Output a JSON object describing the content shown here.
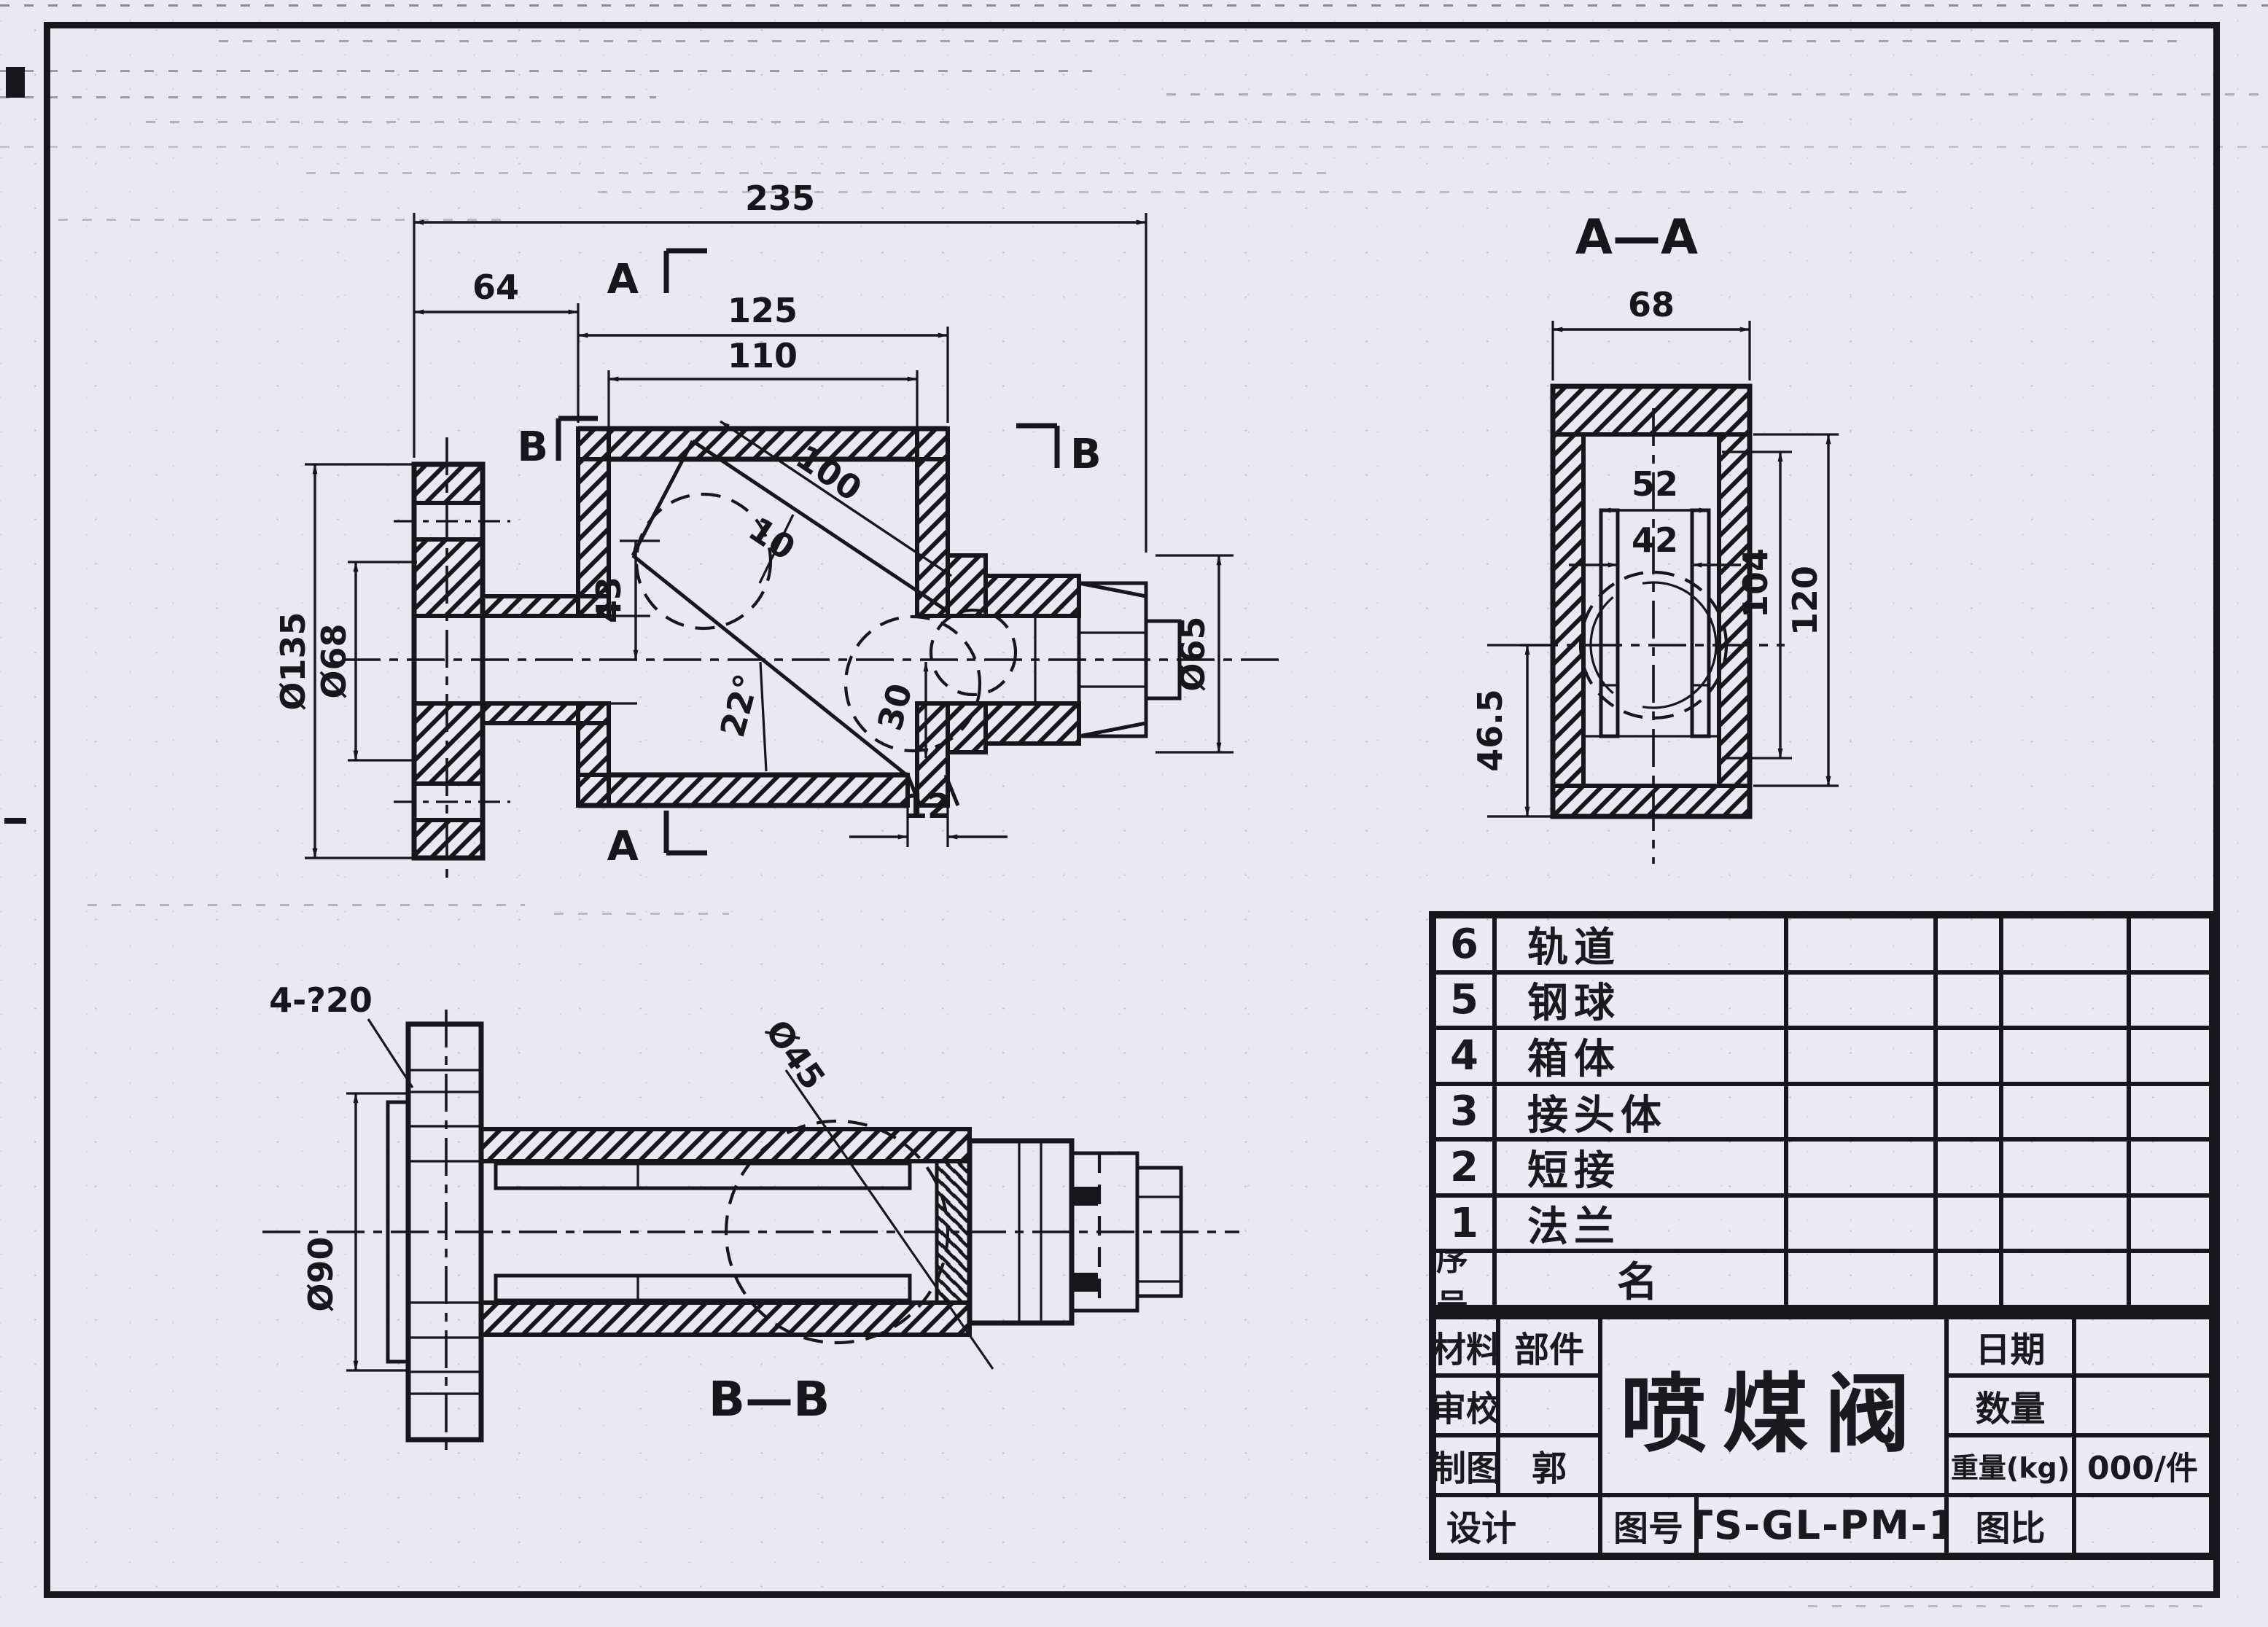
{
  "colors": {
    "paper": "#eae9f1",
    "ink": "#17161c"
  },
  "views": {
    "main": {
      "marker_a_top": "A",
      "marker_a_bottom": "A",
      "marker_b_left": "B",
      "marker_b_right": "B",
      "dims": {
        "overall": "235",
        "left_offset": "64",
        "box_outer": "125",
        "box_inner": "110",
        "flange_od": "Ø135",
        "flange_bore": "Ø68",
        "right_od": "Ø65",
        "channel_len": "100",
        "channel_w": "10",
        "drop": "43",
        "ball_drop": "30",
        "exit_w": "12",
        "angle": "22°"
      }
    },
    "aa": {
      "title": "A—A",
      "dims": {
        "width": "68",
        "rail": "52",
        "ball": "42",
        "inner_h": "104",
        "total_h": "120",
        "left_h": "46.5"
      }
    },
    "bb": {
      "title": "B—B",
      "dims": {
        "bolts": "4-?20",
        "bolt_circle": "Ø90",
        "seat": "Ø45"
      }
    }
  },
  "parts_table": {
    "rows": [
      {
        "no": "6",
        "name": "轨道"
      },
      {
        "no": "5",
        "name": "钢球"
      },
      {
        "no": "4",
        "name": "箱体"
      },
      {
        "no": "3",
        "name": "接头体"
      },
      {
        "no": "2",
        "name": "短接"
      },
      {
        "no": "1",
        "name": "法兰"
      },
      {
        "no": "序号",
        "name": "名"
      }
    ]
  },
  "title_block": {
    "material": "材料",
    "component": "部件",
    "review": "审校",
    "drawn": "制图",
    "drawn_by": "郭",
    "design": "设计",
    "title": "喷煤阀",
    "date": "日期",
    "quantity": "数量",
    "weight": "重量(kg)",
    "weight_value": "000/件",
    "dwg_no_label": "图号",
    "dwg_no": "TS-GL-PM-1",
    "scale": "图比"
  }
}
